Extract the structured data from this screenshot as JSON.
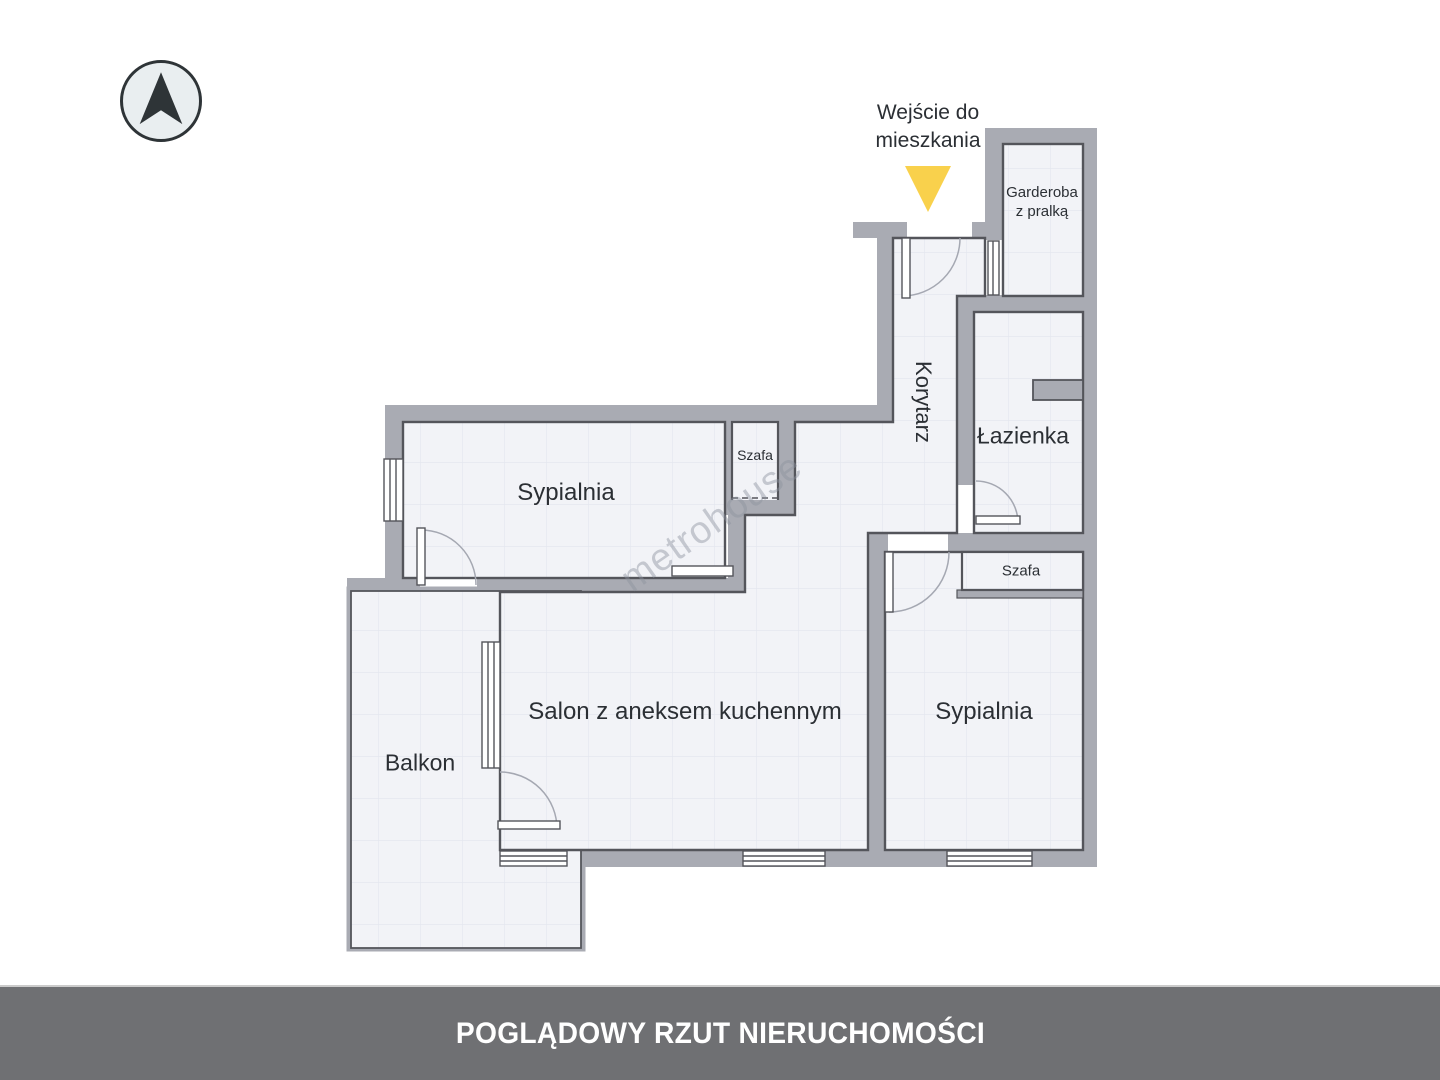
{
  "banner": {
    "title": "POGLĄDOWY RZUT NIERUCHOMOŚCI"
  },
  "entrance": {
    "line1": "Wejście do",
    "line2": "mieszkania"
  },
  "watermark": {
    "text": "metrohouse"
  },
  "rooms": {
    "korytarz": {
      "label": "Korytarz"
    },
    "lazienka": {
      "label": "Łazienka"
    },
    "garderoba": {
      "line1": "Garderoba",
      "line2": "z pralką"
    },
    "szafa_hall": {
      "label": "Szafa"
    },
    "szafa_bedroom": {
      "label": "Szafa"
    },
    "sypialnia_left": {
      "label": "Sypialnia"
    },
    "sypialnia_right": {
      "label": "Sypialnia"
    },
    "salon": {
      "label": "Salon z aneksem kuchennym"
    },
    "balkon": {
      "label": "Balkon"
    }
  },
  "colors": {
    "wall": "#a9abb3",
    "room_outline": "#54555b",
    "room_fill": "#f2f3f7",
    "entrance_arrow": "#f9d14c",
    "banner_bg": "#6f7073",
    "banner_text": "#ffffff",
    "compass_ink": "#2e3437"
  }
}
